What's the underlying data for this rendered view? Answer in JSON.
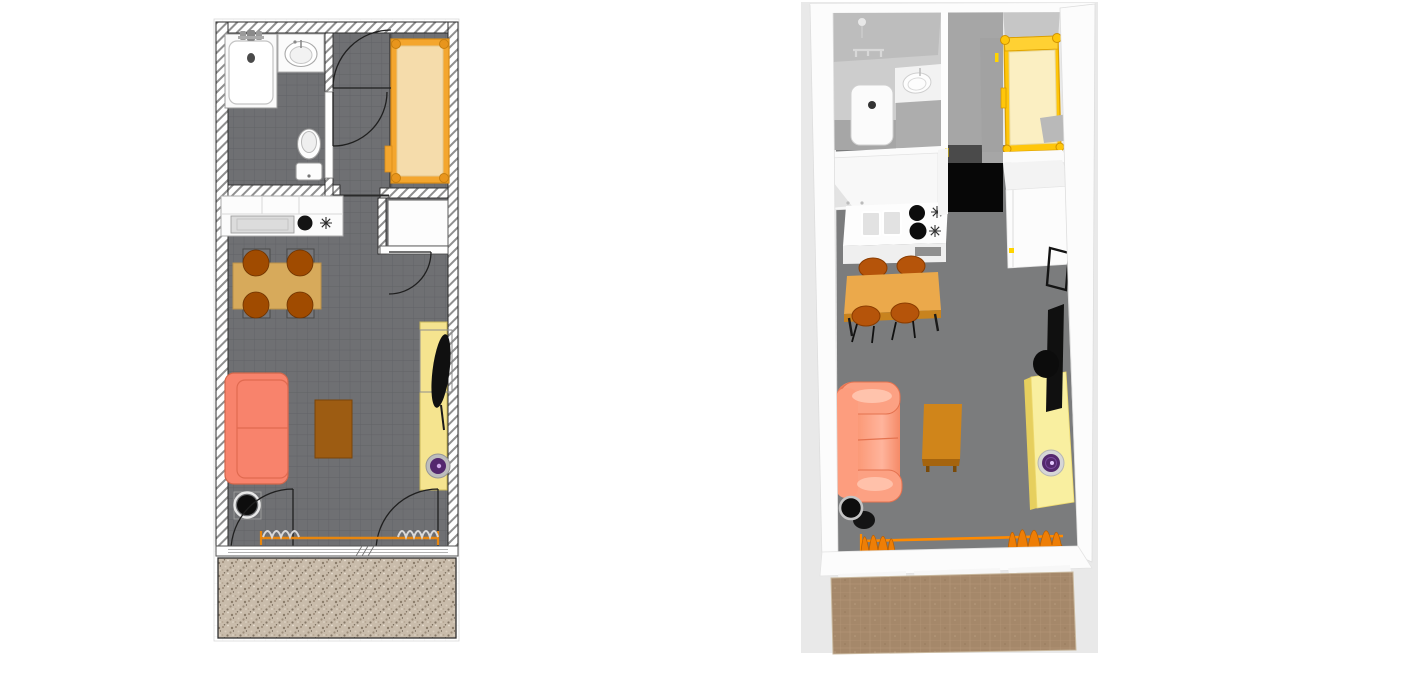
{
  "window": {
    "width": 1416,
    "height": 673,
    "background": "#ffffff"
  },
  "panels": {
    "plan2d": {
      "label": "2d-floor-plan",
      "rooms": [
        "bathroom",
        "hallway",
        "bedroom-nook",
        "kitchen",
        "living-dining",
        "terrace"
      ],
      "furniture": [
        "bathtub",
        "washbasin",
        "toilet",
        "single-bed",
        "wardrobe",
        "kitchen-counter",
        "cooktop-burner",
        "stock-pot",
        "dining-table",
        "chair",
        "chair",
        "chair",
        "chair",
        "sofa",
        "coffee-table",
        "tv-stand",
        "tv",
        "record-player",
        "plant-pot",
        "curtains",
        "entry-doors",
        "window-wall"
      ]
    },
    "view3d": {
      "label": "3d-aerial-view",
      "furniture": [
        "bathtub",
        "washbasin",
        "shower-head",
        "towel-rail",
        "single-bed",
        "wardrobe",
        "fridge-cabinet",
        "kitchen-counter",
        "double-sink",
        "cooktop-burners",
        "oven",
        "dining-table",
        "chair",
        "chair",
        "chair",
        "chair",
        "sofa",
        "coffee-table",
        "tv-stand",
        "tv",
        "wall-mirror",
        "record-player",
        "plant-pot",
        "curtains",
        "window-wall",
        "terrace-deck"
      ]
    }
  },
  "colors": {
    "plan_floor": "#6f7073",
    "hatch_line": "#8f8f8f",
    "wall_edge": "#2b2b2b",
    "bed_frame": "#f4a62e",
    "bed_mattress": "#f5dcab",
    "sofa": "#f8836c",
    "dining_table": "#d7aa5b",
    "chair": "#a04b00",
    "coffee_table": "#9d5c12",
    "tv_stand": "#f5e48f",
    "tv": "#101010",
    "vinyl": "#54286e",
    "curtain": "#e8860e",
    "terrace_2d": "#c9bcab",
    "bg_3d": "#e9e9e9",
    "floor_3d": "#7b7c7d",
    "hall_floor_3d": "#a6a6a6",
    "black_tile_3d": "#070707",
    "bed_frame_3d": "#ffc60a",
    "mattress_3d": "#fbefc2",
    "sofa_3d": "#f9926f",
    "table_3d": "#eba94b",
    "chair_3d": "#b5540a",
    "coffee_3d": "#d0851a",
    "tv_stand_3d": "#f9efa0",
    "curtain_3d": "#ee7e06",
    "terrace_3d": "#a5886a",
    "pot": "#0d0d0d",
    "wall_white": "#fcfcfc"
  }
}
